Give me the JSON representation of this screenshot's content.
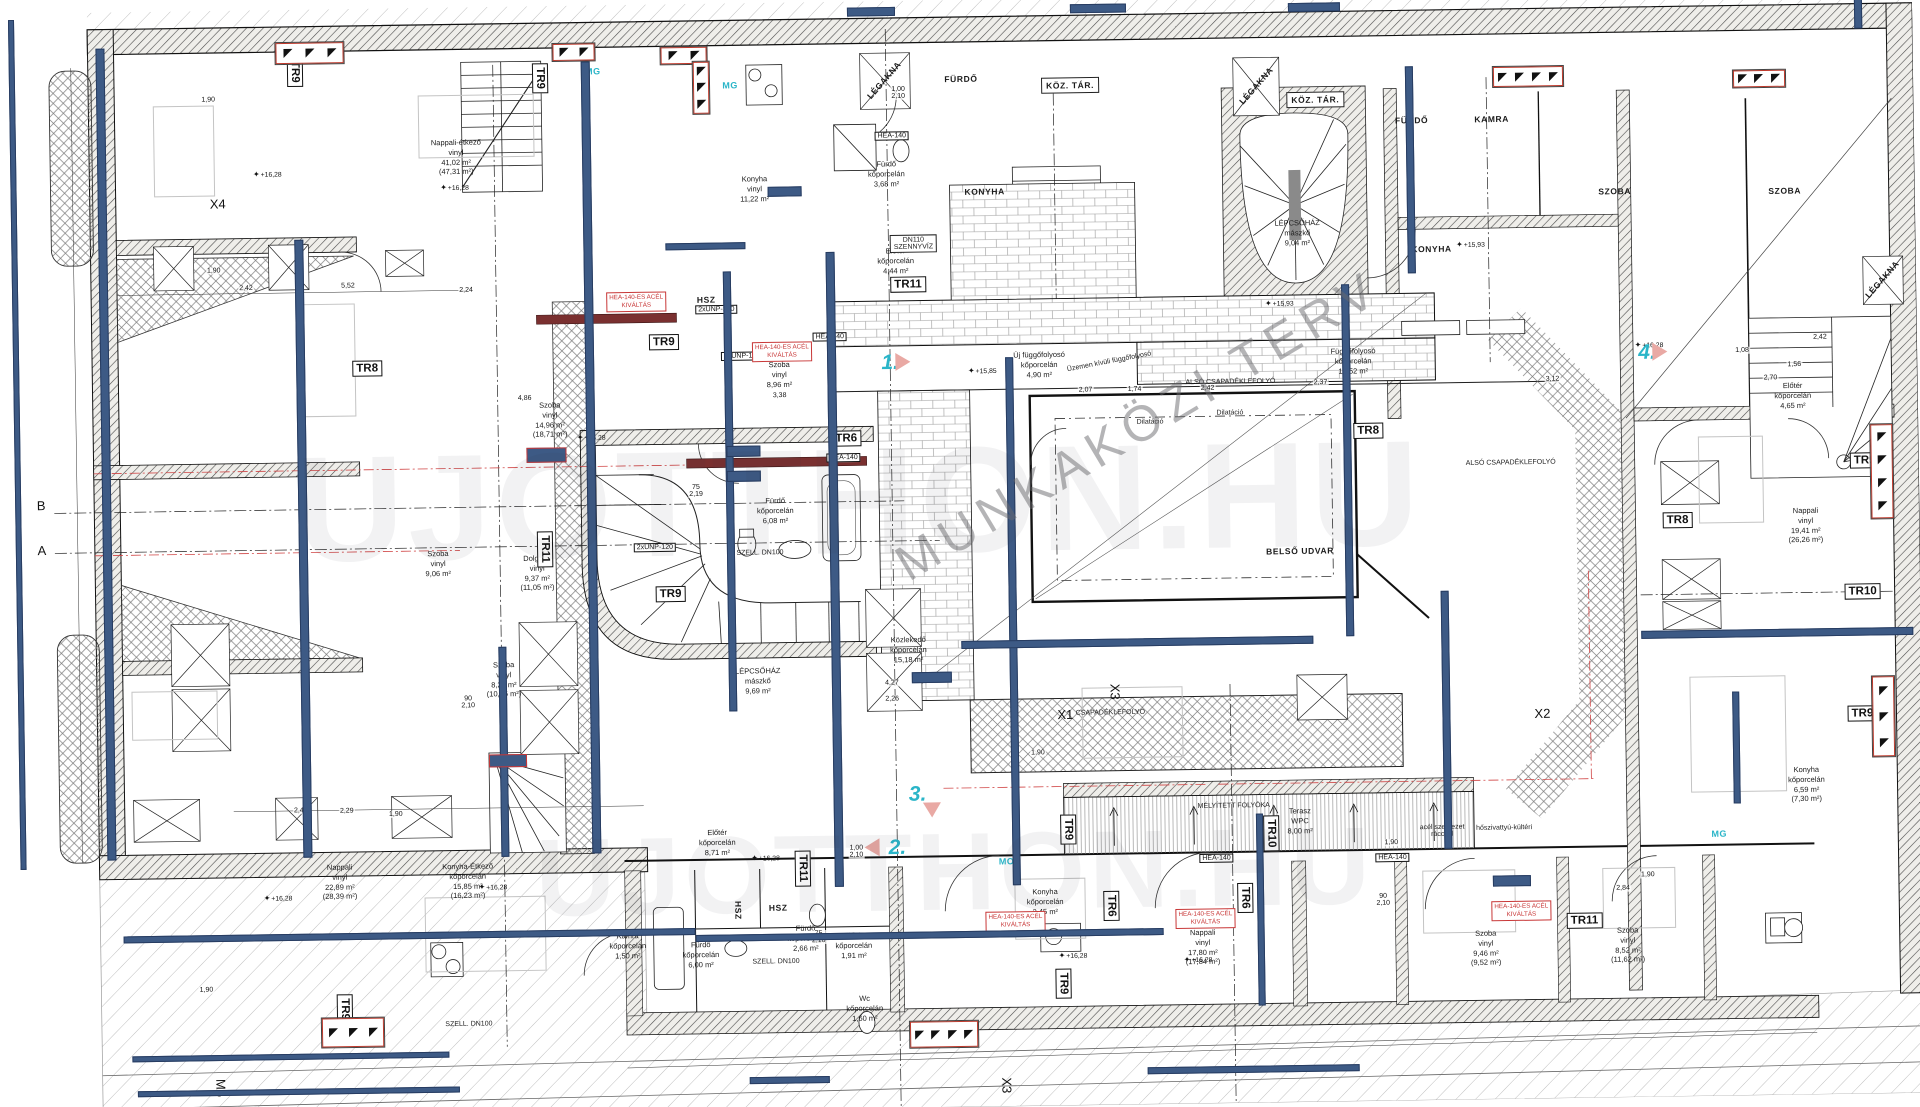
{
  "colors": {
    "beam": "#3d5a85",
    "beam_border": "#273c61",
    "red": "#c83737",
    "teal": "#2ab5c8",
    "pink": "#e9a9a4",
    "wm": "#8a8a8a"
  },
  "watermarks": {
    "diagonal": "MUNKAKÖZI TERV",
    "site": "UJOTTHON.HU",
    "site2": "UJOTTHON.HU"
  },
  "rooms": [
    {
      "t": "Nappali-étkező\nvinyl\n41,02 m²\n(47,31 m²)",
      "x": 462,
      "y": 150
    },
    {
      "t": "Konyha\nvinyl\n11,22 m²",
      "x": 760,
      "y": 186
    },
    {
      "t": "Szoba\nvinyl\n8,96 m²",
      "x": 782,
      "y": 372
    },
    {
      "t": "Szoba\nvinyl\n14,96 m²\n(18,71 m²)",
      "x": 552,
      "y": 414
    },
    {
      "t": "Fürdő\nkőporcelán\n6,08 m²",
      "x": 776,
      "y": 508
    },
    {
      "t": "Dolgozó\nvinyl\n9,37 m²\n(11,05 m²)",
      "x": 537,
      "y": 567
    },
    {
      "t": "Szoba\nvinyl\n9,06 m²",
      "x": 438,
      "y": 556
    },
    {
      "t": "LÉPCSŐHÁZ\nmászkő\n9,69 m²",
      "x": 756,
      "y": 678
    },
    {
      "t": "Közlekedő\nkőporcelán\n15,18 m²",
      "x": 907,
      "y": 649
    },
    {
      "t": "Előtér\nkőporcelán\n8,71 m²",
      "x": 713,
      "y": 839
    },
    {
      "t": "Fürdő\nkőporcelán\n6,00 m²",
      "x": 695,
      "y": 951
    },
    {
      "t": "Fürdő\nkőporcelán\n2,66 m²",
      "x": 800,
      "y": 936
    },
    {
      "t": "Előtér\nkőporcelán\n1,91 m²",
      "x": 848,
      "y": 944
    },
    {
      "t": "Wc\nkőporcelán\n1,60 m²",
      "x": 858,
      "y": 1007
    },
    {
      "t": "Kamra\nkőporcelán\n1,50 m²",
      "x": 622,
      "y": 941
    },
    {
      "t": "Konyha\nkőporcelán\n2,45 m²",
      "x": 1040,
      "y": 903
    },
    {
      "t": "Nappali\nvinyl\n17,80 m²\n(17,84 m²)",
      "x": 1197,
      "y": 951
    },
    {
      "t": "Szoba\nvinyl\n9,46 m²\n(9,52 m²)",
      "x": 1480,
      "y": 956
    },
    {
      "t": "Szoba\nvinyl\n8,52 m²\n(11,62 m²)",
      "x": 1622,
      "y": 955
    },
    {
      "t": "Nappali\nvinyl\n22,89 m²\n(28,39 m²)",
      "x": 335,
      "y": 873
    },
    {
      "t": "Konyha-Étkező\nkőporcelán\n15,85 m²\n(16,23 m²)",
      "x": 463,
      "y": 874
    },
    {
      "t": "Szoba\nvinyl\n8,21 m²\n(10,86 m²)",
      "x": 502,
      "y": 673
    },
    {
      "t": "Nappali\nvinyl\n19,41 m²\n(26,26 m²)",
      "x": 1806,
      "y": 538
    },
    {
      "t": "Konyha\nkőporcelán\n6,59 m²\n(7,30 m²)",
      "x": 1803,
      "y": 797
    },
    {
      "t": "Előtér\nkőporcelán\n4,65 m²",
      "x": 1795,
      "y": 408
    },
    {
      "t": "LÉPCSŐHÁZ\nmászkő\n9,04 m²",
      "x": 1302,
      "y": 238
    },
    {
      "t": "Terasz\nWPC\n8,00 m²",
      "x": 1296,
      "y": 826
    },
    {
      "t": "Új függőfolyosó\nkőporcelán\n4,90 m²",
      "x": 1042,
      "y": 366
    },
    {
      "t": "Függőfolyosó\nkőporcelán\n12,52 m²",
      "x": 1356,
      "y": 367
    },
    {
      "t": "Előtér\nkőporcelán\n4,44 m²",
      "x": 900,
      "y": 260
    },
    {
      "t": "Fürdő\nkőporcelán\n3,68 m²",
      "x": 892,
      "y": 173
    }
  ],
  "caps": [
    {
      "t": "FÜRDŐ",
      "x": 968,
      "y": 79
    },
    {
      "t": "KONYHA",
      "x": 990,
      "y": 192
    },
    {
      "t": "KÖZ. TÁR.",
      "x": 1077,
      "y": 87,
      "boxed": 1
    },
    {
      "t": "KÖZ. TÁR.",
      "x": 1322,
      "y": 105,
      "boxed": 1
    },
    {
      "t": "FÜRDŐ",
      "x": 1418,
      "y": 127
    },
    {
      "t": "KAMRA",
      "x": 1498,
      "y": 127
    },
    {
      "t": "KONYHA",
      "x": 1436,
      "y": 256
    },
    {
      "t": "SZOBA",
      "x": 1620,
      "y": 201
    },
    {
      "t": "SZOBA",
      "x": 1790,
      "y": 203
    },
    {
      "t": "BELSŐ UDVAR",
      "x": 1300,
      "y": 556
    },
    {
      "t": "HSZ",
      "x": 710,
      "y": 296
    },
    {
      "t": "HSZ",
      "x": 773,
      "y": 905
    },
    {
      "t": "HSZ",
      "x": 733,
      "y": 907,
      "rot": 90
    },
    {
      "t": "LÉGAKNA",
      "x": 891,
      "y": 79,
      "rot": -48
    },
    {
      "t": "LÉGAKNA",
      "x": 1263,
      "y": 90,
      "rot": -48
    },
    {
      "t": "LÉGAKNA",
      "x": 1886,
      "y": 293,
      "rot": -48
    }
  ],
  "texts": [
    {
      "t": "ALSÓ CSAPADÉKLEFOLYÓ",
      "x": 1233,
      "y": 386
    },
    {
      "t": "ALSÓ CSAPADÉKLEFOLYÓ",
      "x": 1512,
      "y": 471
    },
    {
      "t": "CSAPADÉKLEFOLYÓ",
      "x": 1108,
      "y": 715
    },
    {
      "t": "Dilatáció",
      "x": 1232,
      "y": 417
    },
    {
      "t": "MÉLYÍTETT FOLYÓKA",
      "x": 1230,
      "y": 810
    },
    {
      "t": "hőszivattyú-kültéri",
      "x": 1500,
      "y": 836
    },
    {
      "t": "acél szerkezet\nráccsal",
      "x": 1438,
      "y": 838
    },
    {
      "t": "Üzemen kívüli függőfolyosó",
      "x": 1112,
      "y": 364,
      "rot": -10
    },
    {
      "t": "SZELL. DN100",
      "x": 770,
      "y": 959
    },
    {
      "t": "SZELL. DN100",
      "x": 462,
      "y": 1017
    },
    {
      "t": "SZELL. DN100",
      "x": 760,
      "y": 550
    },
    {
      "t": "DN110\nSZENNYVÍZ",
      "x": 918,
      "y": 243,
      "boxed": 1
    },
    {
      "t": "Dilatáció",
      "x": 1152,
      "y": 425
    }
  ],
  "axes": [
    {
      "t": "B",
      "x": 42,
      "y": 492
    },
    {
      "t": "A",
      "x": 42,
      "y": 537
    },
    {
      "t": "X4",
      "x": 223,
      "y": 193
    },
    {
      "t": "X1",
      "x": 1063,
      "y": 716
    },
    {
      "t": "X2",
      "x": 1540,
      "y": 722
    },
    {
      "t": "X3",
      "x": 1113,
      "y": 694,
      "rot": 90
    },
    {
      "t": "X3",
      "x": 999,
      "y": 1086,
      "rot": 90
    },
    {
      "t": "M5",
      "x": 213,
      "y": 1077,
      "rot": 90
    }
  ],
  "dims": [
    {
      "t": "1,90",
      "x": 215,
      "y": 89
    },
    {
      "t": "1,90",
      "x": 218,
      "y": 260
    },
    {
      "t": "2,42",
      "x": 250,
      "y": 278
    },
    {
      "t": "5,52",
      "x": 352,
      "y": 277
    },
    {
      "t": "2,24",
      "x": 470,
      "y": 283
    },
    {
      "t": "4,86",
      "x": 527,
      "y": 392
    },
    {
      "t": "3,38",
      "x": 782,
      "y": 393
    },
    {
      "t": "2,07",
      "x": 1088,
      "y": 392
    },
    {
      "t": "1,74",
      "x": 1137,
      "y": 392
    },
    {
      "t": "2,42",
      "x": 1210,
      "y": 392
    },
    {
      "t": "2,37",
      "x": 1323,
      "y": 388
    },
    {
      "t": "3,12",
      "x": 1555,
      "y": 388
    },
    {
      "t": "2,42",
      "x": 297,
      "y": 801
    },
    {
      "t": "2,29",
      "x": 343,
      "y": 802
    },
    {
      "t": "1,90",
      "x": 392,
      "y": 806
    },
    {
      "t": "4,27",
      "x": 890,
      "y": 682
    },
    {
      "t": "2,26",
      "x": 890,
      "y": 698
    },
    {
      "t": "1,90",
      "x": 1035,
      "y": 754
    },
    {
      "t": "1,90",
      "x": 1387,
      "y": 849
    },
    {
      "t": "3,45",
      "x": 1510,
      "y": 892
    },
    {
      "t": "1,90",
      "x": 1643,
      "y": 885
    },
    {
      "t": "2,84",
      "x": 1618,
      "y": 898
    },
    {
      "t": "2,70",
      "x": 1773,
      "y": 390
    },
    {
      "t": "2,42",
      "x": 1823,
      "y": 350
    },
    {
      "t": "1,56",
      "x": 1797,
      "y": 377
    },
    {
      "t": "1,08",
      "x": 1745,
      "y": 362
    },
    {
      "t": "1,90",
      "x": 200,
      "y": 979
    },
    {
      "t": "75\n2,19",
      "x": 697,
      "y": 487
    },
    {
      "t": "1,00\n2,10",
      "x": 852,
      "y": 850
    },
    {
      "t": "1,00\n2,10",
      "x": 905,
      "y": 92
    },
    {
      "t": "75\n2,10",
      "x": 813,
      "y": 935
    },
    {
      "t": "90\n2,10",
      "x": 1378,
      "y": 906
    },
    {
      "t": "90\n2,10",
      "x": 466,
      "y": 695
    }
  ],
  "levels": [
    {
      "t": "+16,28",
      "x": 273,
      "y": 164
    },
    {
      "t": "+16,28",
      "x": 460,
      "y": 180
    },
    {
      "t": "+16,28",
      "x": 593,
      "y": 432
    },
    {
      "t": "+16,28",
      "x": 761,
      "y": 855
    },
    {
      "t": "+15,85",
      "x": 985,
      "y": 371
    },
    {
      "t": "+15,93",
      "x": 1283,
      "y": 308
    },
    {
      "t": "+15,93",
      "x": 1475,
      "y": 252
    },
    {
      "t": "+16,28",
      "x": 1652,
      "y": 355
    },
    {
      "t": "+16,28",
      "x": 1192,
      "y": 963
    },
    {
      "t": "+16,28",
      "x": 273,
      "y": 888
    },
    {
      "t": "+16,28",
      "x": 488,
      "y": 880
    },
    {
      "t": "+16,28",
      "x": 1067,
      "y": 957
    }
  ],
  "tr_tags": [
    {
      "t": "TR9",
      "x": 302,
      "y": 62,
      "rot": 90
    },
    {
      "t": "TR9",
      "x": 547,
      "y": 72,
      "rot": 90
    },
    {
      "t": "TR8",
      "x": 370,
      "y": 360
    },
    {
      "t": "TR9",
      "x": 667,
      "y": 338
    },
    {
      "t": "TR11",
      "x": 545,
      "y": 543,
      "rot": 90
    },
    {
      "t": "TR6",
      "x": 848,
      "y": 437
    },
    {
      "t": "TR9",
      "x": 670,
      "y": 590
    },
    {
      "t": "TR11",
      "x": 912,
      "y": 284
    },
    {
      "t": "TR8",
      "x": 1370,
      "y": 437
    },
    {
      "t": "TR8",
      "x": 1678,
      "y": 531
    },
    {
      "t": "TR9",
      "x": 1866,
      "y": 474
    },
    {
      "t": "TR10",
      "x": 1862,
      "y": 605
    },
    {
      "t": "TR9",
      "x": 1860,
      "y": 727
    },
    {
      "t": "TR6",
      "x": 1106,
      "y": 908,
      "rot": 90
    },
    {
      "t": "TR9",
      "x": 1064,
      "y": 831,
      "rot": 90
    },
    {
      "t": "TR10",
      "x": 1267,
      "y": 838,
      "rot": 90
    },
    {
      "t": "TR11",
      "x": 1579,
      "y": 930
    },
    {
      "t": "TR9",
      "x": 1057,
      "y": 985,
      "rot": 90
    },
    {
      "t": "TR9",
      "x": 338,
      "y": 1000,
      "rot": 90
    },
    {
      "t": "TR6",
      "x": 1240,
      "y": 902,
      "rot": 90
    },
    {
      "t": "TR11",
      "x": 798,
      "y": 866,
      "rot": 90
    }
  ],
  "steel_tags": [
    {
      "t": "HEA-140",
      "x": 845,
      "y": 456
    },
    {
      "t": "HEA-140",
      "x": 833,
      "y": 335
    },
    {
      "t": "HEA-140",
      "x": 898,
      "y": 135
    },
    {
      "t": "HEA-140",
      "x": 1212,
      "y": 862
    },
    {
      "t": "HEA-140",
      "x": 1388,
      "y": 864
    },
    {
      "t": "2xUNP-100",
      "x": 720,
      "y": 306
    },
    {
      "t": "2xUNP-100",
      "x": 745,
      "y": 353
    },
    {
      "t": "2xUNP-120",
      "x": 655,
      "y": 543
    }
  ],
  "red_tags": [
    {
      "t": "HEA-140-ES ACÉL\nKIVÁLTÁS",
      "x": 640,
      "y": 297
    },
    {
      "t": "HEA-140-ES ACÉL\nKIVÁLTÁS",
      "x": 785,
      "y": 349
    },
    {
      "t": "HEA-140-ES ACÉL\nKIVÁLTÁS",
      "x": 1010,
      "y": 922
    },
    {
      "t": "HEA-140-ES ACÉL\nKIVÁLTÁS",
      "x": 1200,
      "y": 922
    },
    {
      "t": "HEA-140-ES ACÉL\nKIVÁLTÁS",
      "x": 1516,
      "y": 919
    }
  ],
  "chips": [
    {
      "x": 745,
      "y": 448,
      "w": 32,
      "h": 9
    },
    {
      "x": 745,
      "y": 473,
      "w": 32,
      "h": 9
    },
    {
      "x": 930,
      "y": 677,
      "w": 38,
      "h": 9
    },
    {
      "x": 505,
      "y": 754,
      "w": 36,
      "h": 11,
      "red": 1
    },
    {
      "x": 548,
      "y": 449,
      "w": 38,
      "h": 13,
      "red": 1
    },
    {
      "x": 790,
      "y": 189,
      "w": 32,
      "h": 8
    },
    {
      "x": 1507,
      "y": 889,
      "w": 36,
      "h": 9
    }
  ],
  "teal_marks": [
    {
      "t": "MG",
      "x": 737,
      "y": 82
    },
    {
      "t": "MG",
      "x": 600,
      "y": 66
    },
    {
      "t": "MO",
      "x": 1002,
      "y": 862
    },
    {
      "t": "MG",
      "x": 1715,
      "y": 845
    }
  ],
  "apartment_numbers": [
    {
      "t": "1.",
      "x": 893,
      "y": 362,
      "dir": "r"
    },
    {
      "t": "2.",
      "x": 893,
      "y": 847,
      "dir": "l"
    },
    {
      "t": "3.",
      "x": 914,
      "y": 794,
      "dir": "d"
    },
    {
      "t": "4.",
      "x": 1650,
      "y": 363,
      "dir": "r"
    }
  ],
  "windows": [
    {
      "x": 283,
      "y": 33,
      "w": 68,
      "h": 21,
      "n": 3
    },
    {
      "x": 560,
      "y": 38,
      "w": 42,
      "h": 17,
      "n": 2
    },
    {
      "x": 668,
      "y": 43,
      "w": 46,
      "h": 17,
      "n": 2
    },
    {
      "x": 1500,
      "y": 75,
      "w": 70,
      "h": 20,
      "n": 4
    },
    {
      "x": 1740,
      "y": 82,
      "w": 52,
      "h": 17,
      "n": 3
    },
    {
      "x": 315,
      "y": 1009,
      "w": 62,
      "h": 29,
      "n": 3
    },
    {
      "x": 903,
      "y": 1021,
      "w": 68,
      "h": 26,
      "n": 4
    },
    {
      "x": 700,
      "y": 58,
      "w": 16,
      "h": 52,
      "n": 3,
      "v": 1
    },
    {
      "x": 1872,
      "y": 438,
      "w": 22,
      "h": 94,
      "n": 4,
      "v": 1
    },
    {
      "x": 1870,
      "y": 690,
      "w": 22,
      "h": 80,
      "n": 3,
      "v": 1
    }
  ],
  "beams": {
    "v": [
      [
        16,
        6,
        6,
        850
      ],
      [
        103,
        36,
        9,
        812
      ],
      [
        299,
        230,
        9,
        618
      ],
      [
        588,
        56,
        9,
        792
      ],
      [
        727,
        268,
        8,
        440
      ],
      [
        830,
        250,
        9,
        635
      ],
      [
        1008,
        358,
        8,
        528
      ],
      [
        1345,
        290,
        8,
        352
      ],
      [
        1412,
        73,
        8,
        207
      ],
      [
        1440,
        598,
        8,
        258
      ],
      [
        1252,
        818,
        7,
        192
      ],
      [
        1862,
        2,
        8,
        40
      ],
      [
        497,
        640,
        8,
        210
      ],
      [
        1730,
        703,
        7,
        112
      ]
    ],
    "h": [
      [
        960,
        641,
        352,
        8
      ],
      [
        1640,
        641,
        272,
        8
      ],
      [
        118,
        924,
        572,
        7
      ],
      [
        690,
        931,
        468,
        7
      ],
      [
        125,
        1044,
        317,
        6
      ],
      [
        130,
        1079,
        322,
        6
      ],
      [
        742,
        1074,
        80,
        7
      ],
      [
        1140,
        1070,
        212,
        7
      ],
      [
        855,
        6,
        48,
        9
      ],
      [
        1078,
        6,
        56,
        9
      ],
      [
        1296,
        8,
        52,
        9
      ],
      [
        670,
        239,
        80,
        7
      ]
    ]
  }
}
